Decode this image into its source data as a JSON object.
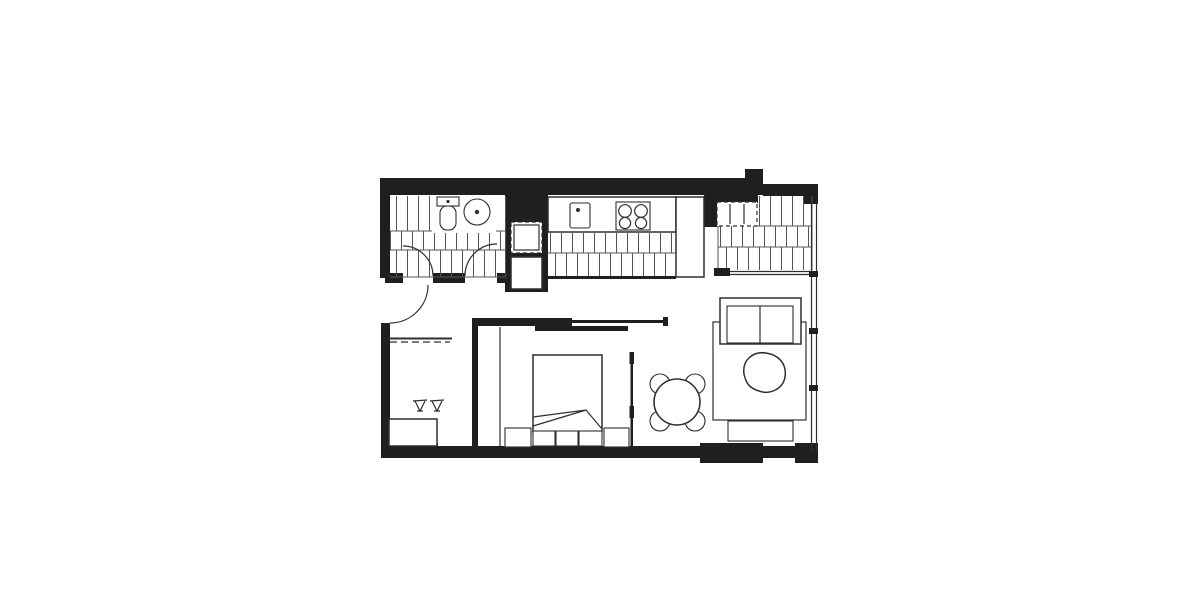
{
  "document": {
    "kind": "apartment-floor-plan",
    "visible_text": [],
    "colors": {
      "wall": "#1f1f1f",
      "line": "#2e2e2e",
      "hatch": "#555555",
      "background": "#ffffff"
    },
    "rooms": [
      {
        "name": "bathroom",
        "floor": "tiled-hatch",
        "position": "top-left"
      },
      {
        "name": "kitchen",
        "floor": "tiled-hatch",
        "position": "top-center"
      },
      {
        "name": "laundry-wardrobe",
        "floor": "tiled-hatch",
        "position": "top-right"
      },
      {
        "name": "entry-hall-study",
        "position": "left"
      },
      {
        "name": "bedroom",
        "position": "center"
      },
      {
        "name": "living-dining",
        "position": "right"
      }
    ],
    "fixtures": [
      "entry-door-swing",
      "bathroom-door-swing-left",
      "bathroom-door-swing-right",
      "toilet",
      "round-basin",
      "kitchen-sink",
      "cooktop-4-burner",
      "fridge-space-dashed",
      "appliance-space-dashed",
      "tall-cabinet",
      "coat-rail-shelf",
      "desk",
      "desk-chair",
      "double-bed",
      "bedside-table-left",
      "bedside-table-right",
      "bed-foot-storage",
      "wardrobe-panel",
      "sliding-door-top",
      "sliding-door-bedroom-living",
      "dining-table-round",
      "dining-chairs-4",
      "sofa-two-seat",
      "coffee-table-organic",
      "rug",
      "tv-unit",
      "window-wall-right"
    ]
  }
}
